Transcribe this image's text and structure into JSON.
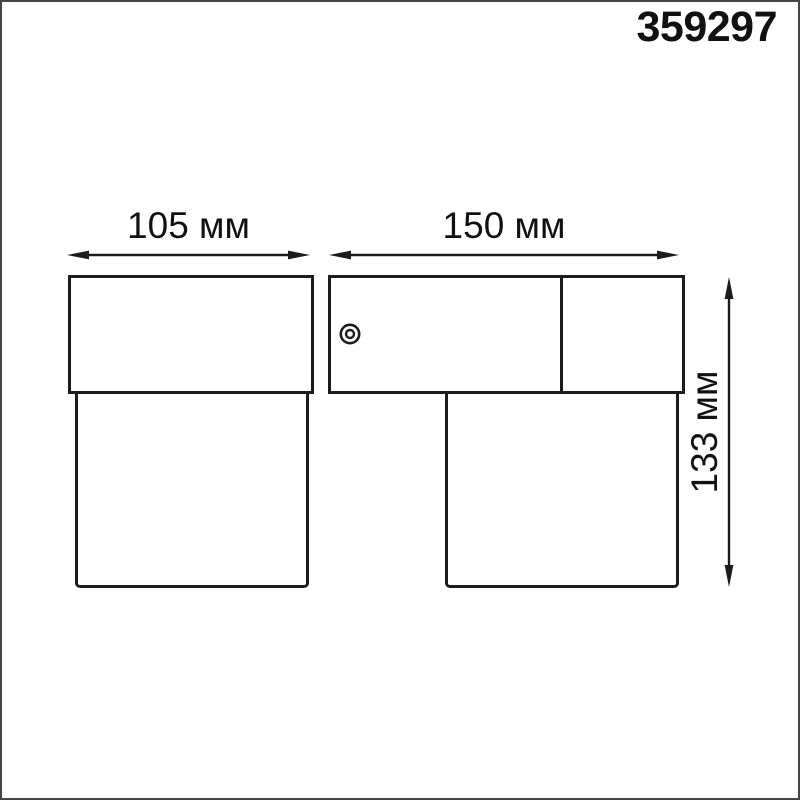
{
  "product": {
    "code": "359297"
  },
  "dimensions": {
    "width": {
      "value": 105,
      "unit": "мм",
      "label": "105 мм"
    },
    "depth": {
      "value": 150,
      "unit": "мм",
      "label": "150 мм"
    },
    "height": {
      "value": 133,
      "unit": "мм",
      "label": "133 мм"
    }
  },
  "icons": {
    "screw": "concentric-circles"
  },
  "colors": {
    "line": "#1c1c1c",
    "text": "#111111",
    "background": "#ffffff",
    "page_border": "#454545"
  }
}
